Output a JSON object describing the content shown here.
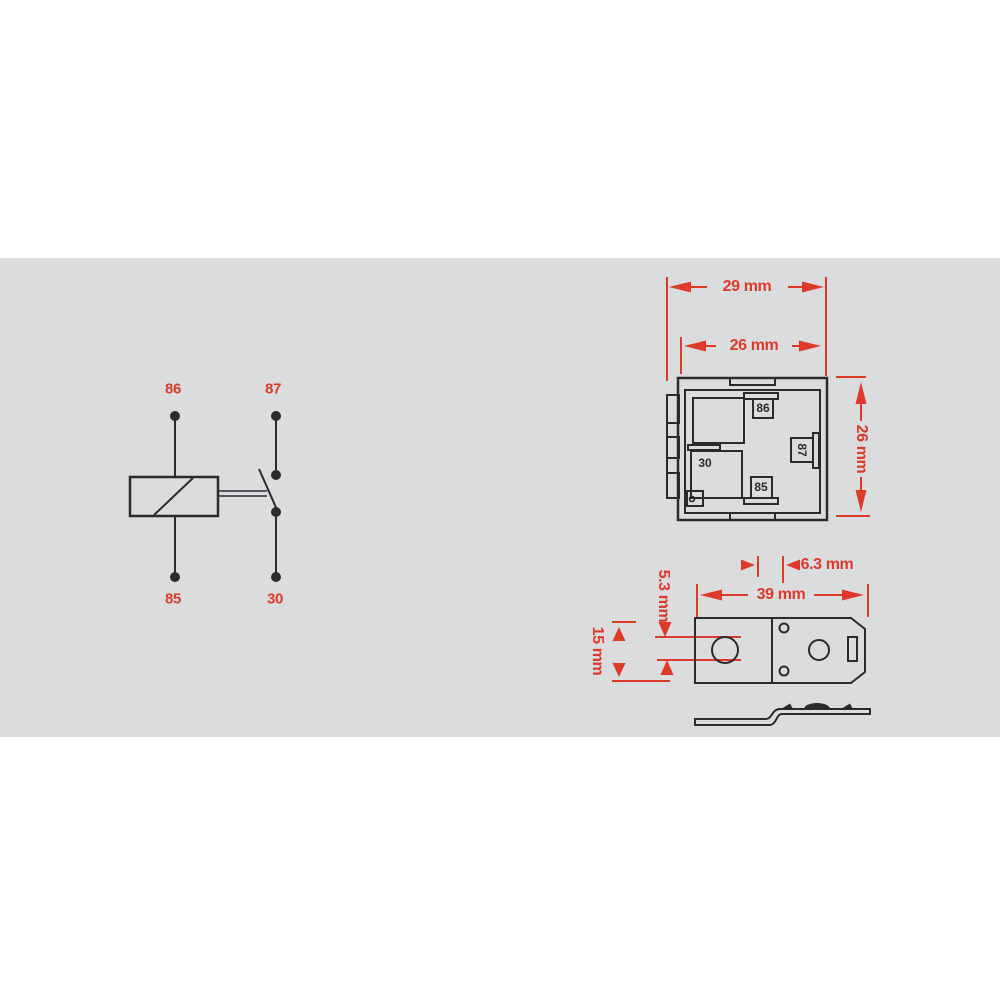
{
  "colors": {
    "accent_red": "#dd3a2a",
    "line_dark": "#2b2b2e",
    "band_gray": "#dbdcde",
    "page_bg": "#ffffff"
  },
  "schematic": {
    "pins": {
      "top_left": "86",
      "top_right": "87",
      "bottom_left": "85",
      "bottom_right": "30"
    }
  },
  "bottom_view": {
    "dims": {
      "outer_width": "29 mm",
      "inner_width": "26 mm",
      "body_height": "26 mm"
    },
    "terminals": {
      "t86": "86",
      "t30": "30",
      "t85": "85",
      "t87": "87"
    }
  },
  "bracket_view": {
    "dims": {
      "tab": "6.3 mm",
      "length": "39 mm",
      "hole": "5.3 mm",
      "width": "15 mm"
    }
  }
}
